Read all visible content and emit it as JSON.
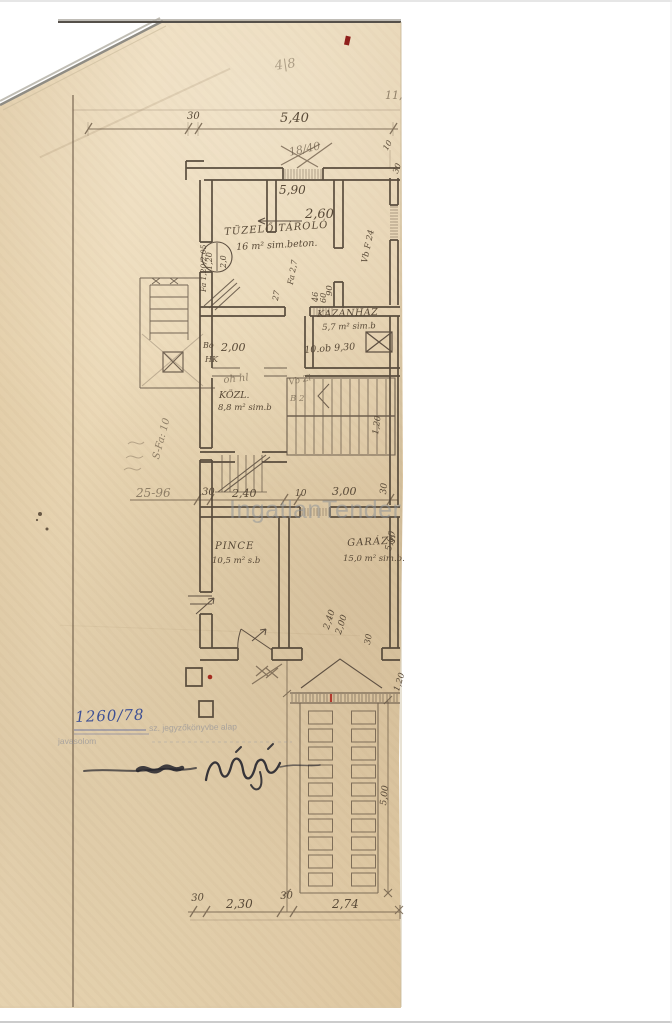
{
  "page": {
    "watermark": "IngatlanTender"
  },
  "rooms": {
    "tuzelo": {
      "name": "TÜZELŐ TÁROLÓ",
      "area": "16 m² sim.beton."
    },
    "kazanhaz": {
      "name": "KAZÁNHÁZ",
      "area": "5,7 m² sim.b"
    },
    "kozl": {
      "name": "KÖZL.",
      "area": "8,8 m² sim.b"
    },
    "pince": {
      "name": "PINCE",
      "area": "10,5 m² s.b"
    },
    "garazs": {
      "name": "GARÁZS",
      "area": "15,0 m² sim.b."
    }
  },
  "dims": {
    "top30": "30",
    "top540": "5,40",
    "w590": "5,90",
    "w260": "2,60",
    "v90": "90",
    "v46": "46",
    "v60": "60",
    "v27": "27",
    "r10": "10",
    "r30": "30",
    "k200": "2,00",
    "stair120": "1,20",
    "mid30": "30",
    "mid240": "2,40",
    "mid10": "10",
    "mid300": "3,00",
    "mid30r": "30",
    "g560": "5,60",
    "gd240": "2,40",
    "gd200": "2,00",
    "gd30": "30",
    "gd120": "1,20",
    "ramp500": "5,00",
    "bot30a": "30",
    "bot230": "2,30",
    "bot30b": "30",
    "bot274": "2,74"
  },
  "door": {
    "width": "1,20",
    "height": "2,0"
  },
  "notes": {
    "pencil_top": "4|8",
    "corner": "11,",
    "crossed": "18/40",
    "fa205": "Fa 1,20/2,05",
    "vbf24": "Vb F 24",
    "fa27": "Fa 2,7",
    "bo": "Bo",
    "hk": "HK",
    "ohhl": "oh hl",
    "vbzl": "Vb Zl",
    "b2": "B 2",
    "sfa": "S-Fa: 10",
    "n2596": "25-96",
    "kazan_ob": "10.ob 9,30"
  },
  "stamp": {
    "registry": "1260/78",
    "line1": "sz. jegyzőkönyvbe alap",
    "line2": "javasolom"
  }
}
